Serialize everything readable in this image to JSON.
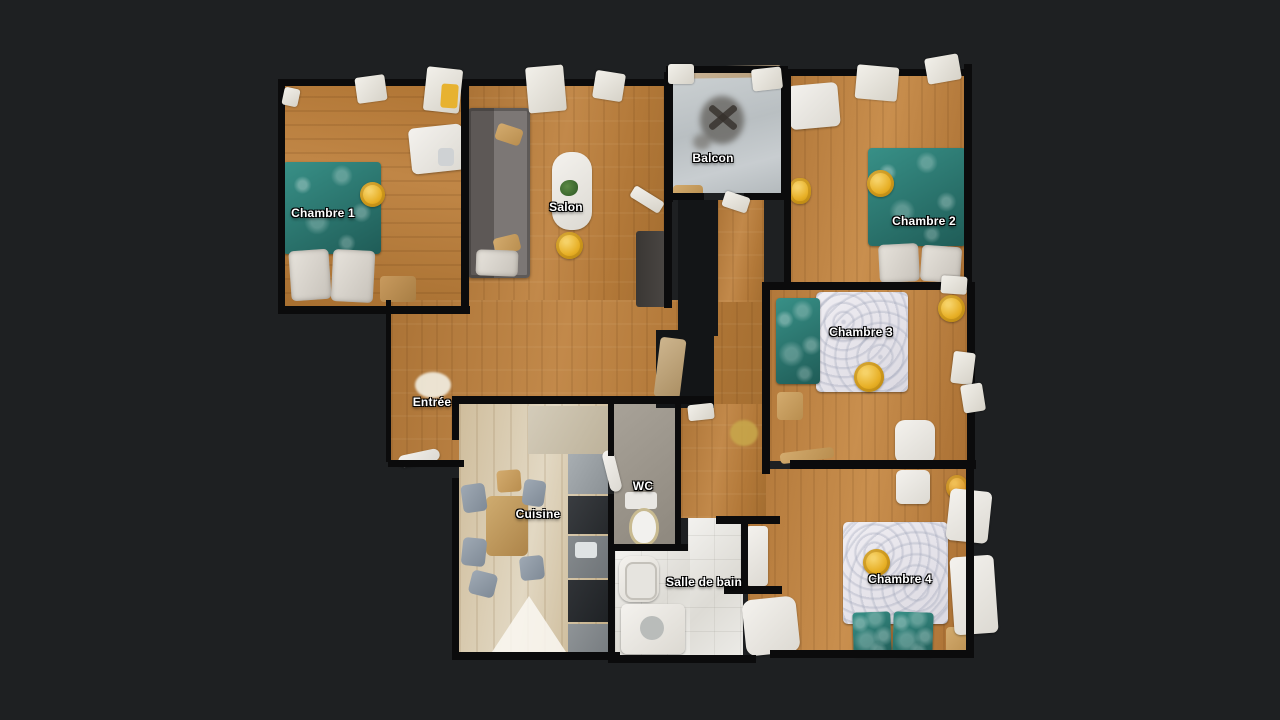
{
  "view": {
    "title": "3D dollhouse floor plan",
    "background_color": "#1e2022"
  },
  "rooms": [
    {
      "id": "chambre-1",
      "label": "Chambre 1"
    },
    {
      "id": "salon",
      "label": "Salon"
    },
    {
      "id": "balcon",
      "label": "Balcon"
    },
    {
      "id": "chambre-2",
      "label": "Chambre 2"
    },
    {
      "id": "chambre-3",
      "label": "Chambre 3"
    },
    {
      "id": "entree",
      "label": "Entrée"
    },
    {
      "id": "cuisine",
      "label": "Cuisine"
    },
    {
      "id": "wc",
      "label": "WC"
    },
    {
      "id": "salle-de-bain",
      "label": "Salle de bain"
    },
    {
      "id": "chambre-4",
      "label": "Chambre 4"
    }
  ],
  "palette": {
    "background": "#1e2022",
    "wall": "#0b0b0c",
    "wood": "#b57b3c",
    "wood_light": "#d2c3a0",
    "tile_white": "#e9e8e4",
    "balcony_concrete": "#c3c6c0",
    "bed_teal": "#2e7a74",
    "accent_yellow": "#e6b033",
    "sofa_gray": "#6e6967",
    "label_text": "#ffffff"
  }
}
